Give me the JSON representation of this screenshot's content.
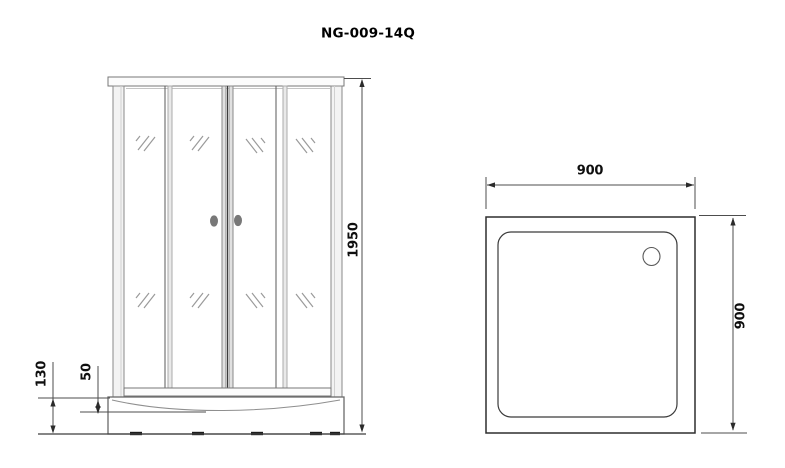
{
  "title": "NG-009-14Q",
  "front_view": {
    "height": "1950",
    "tray_height": "130",
    "basin_depth": "50"
  },
  "top_view": {
    "width": "900",
    "depth": "900"
  },
  "colors": {
    "background": "#ffffff",
    "frame_line": "#8a8a8a",
    "outline_dark": "#2e2e2e",
    "dimension_line": "#4d4d4d",
    "label_text": "#0f0f0f",
    "handle_gray": "#787878"
  }
}
